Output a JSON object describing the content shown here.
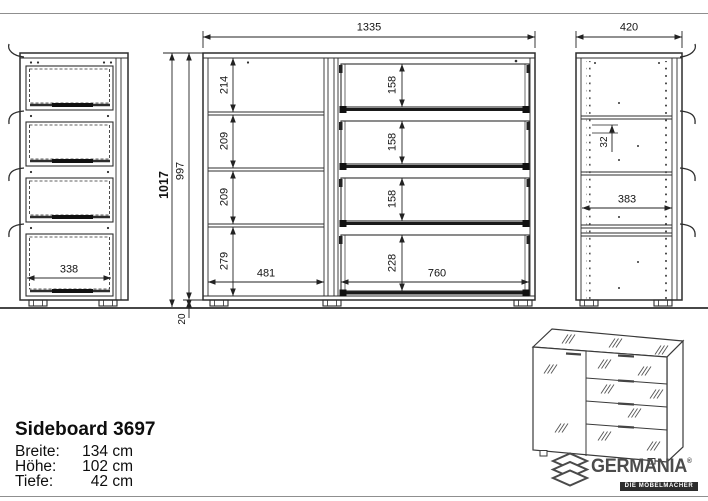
{
  "title_block": {
    "model": "Sideboard 3697",
    "specs": [
      {
        "label": "Breite:",
        "value": "134 cm"
      },
      {
        "label": "Höhe:",
        "value": "102 cm"
      },
      {
        "label": "Tiefe:",
        "value": "42 cm"
      }
    ]
  },
  "views": {
    "front": {
      "width": "1335",
      "height_total": "1017",
      "height_body": "997",
      "plinth": "20",
      "shelf_heights": [
        "214",
        "209",
        "209",
        "279"
      ],
      "shelf_width": "481",
      "drawer_heights": [
        "158",
        "158",
        "158",
        "228"
      ],
      "drawer_width": "760"
    },
    "side_left": {
      "drawer_depth": "338"
    },
    "side_right": {
      "width": "420",
      "hole_pitch": "32",
      "inner_depth": "383"
    }
  },
  "brand": {
    "name": "GERMANIA",
    "mark": "®",
    "tagline": "DIE MÖBELMACHER"
  }
}
